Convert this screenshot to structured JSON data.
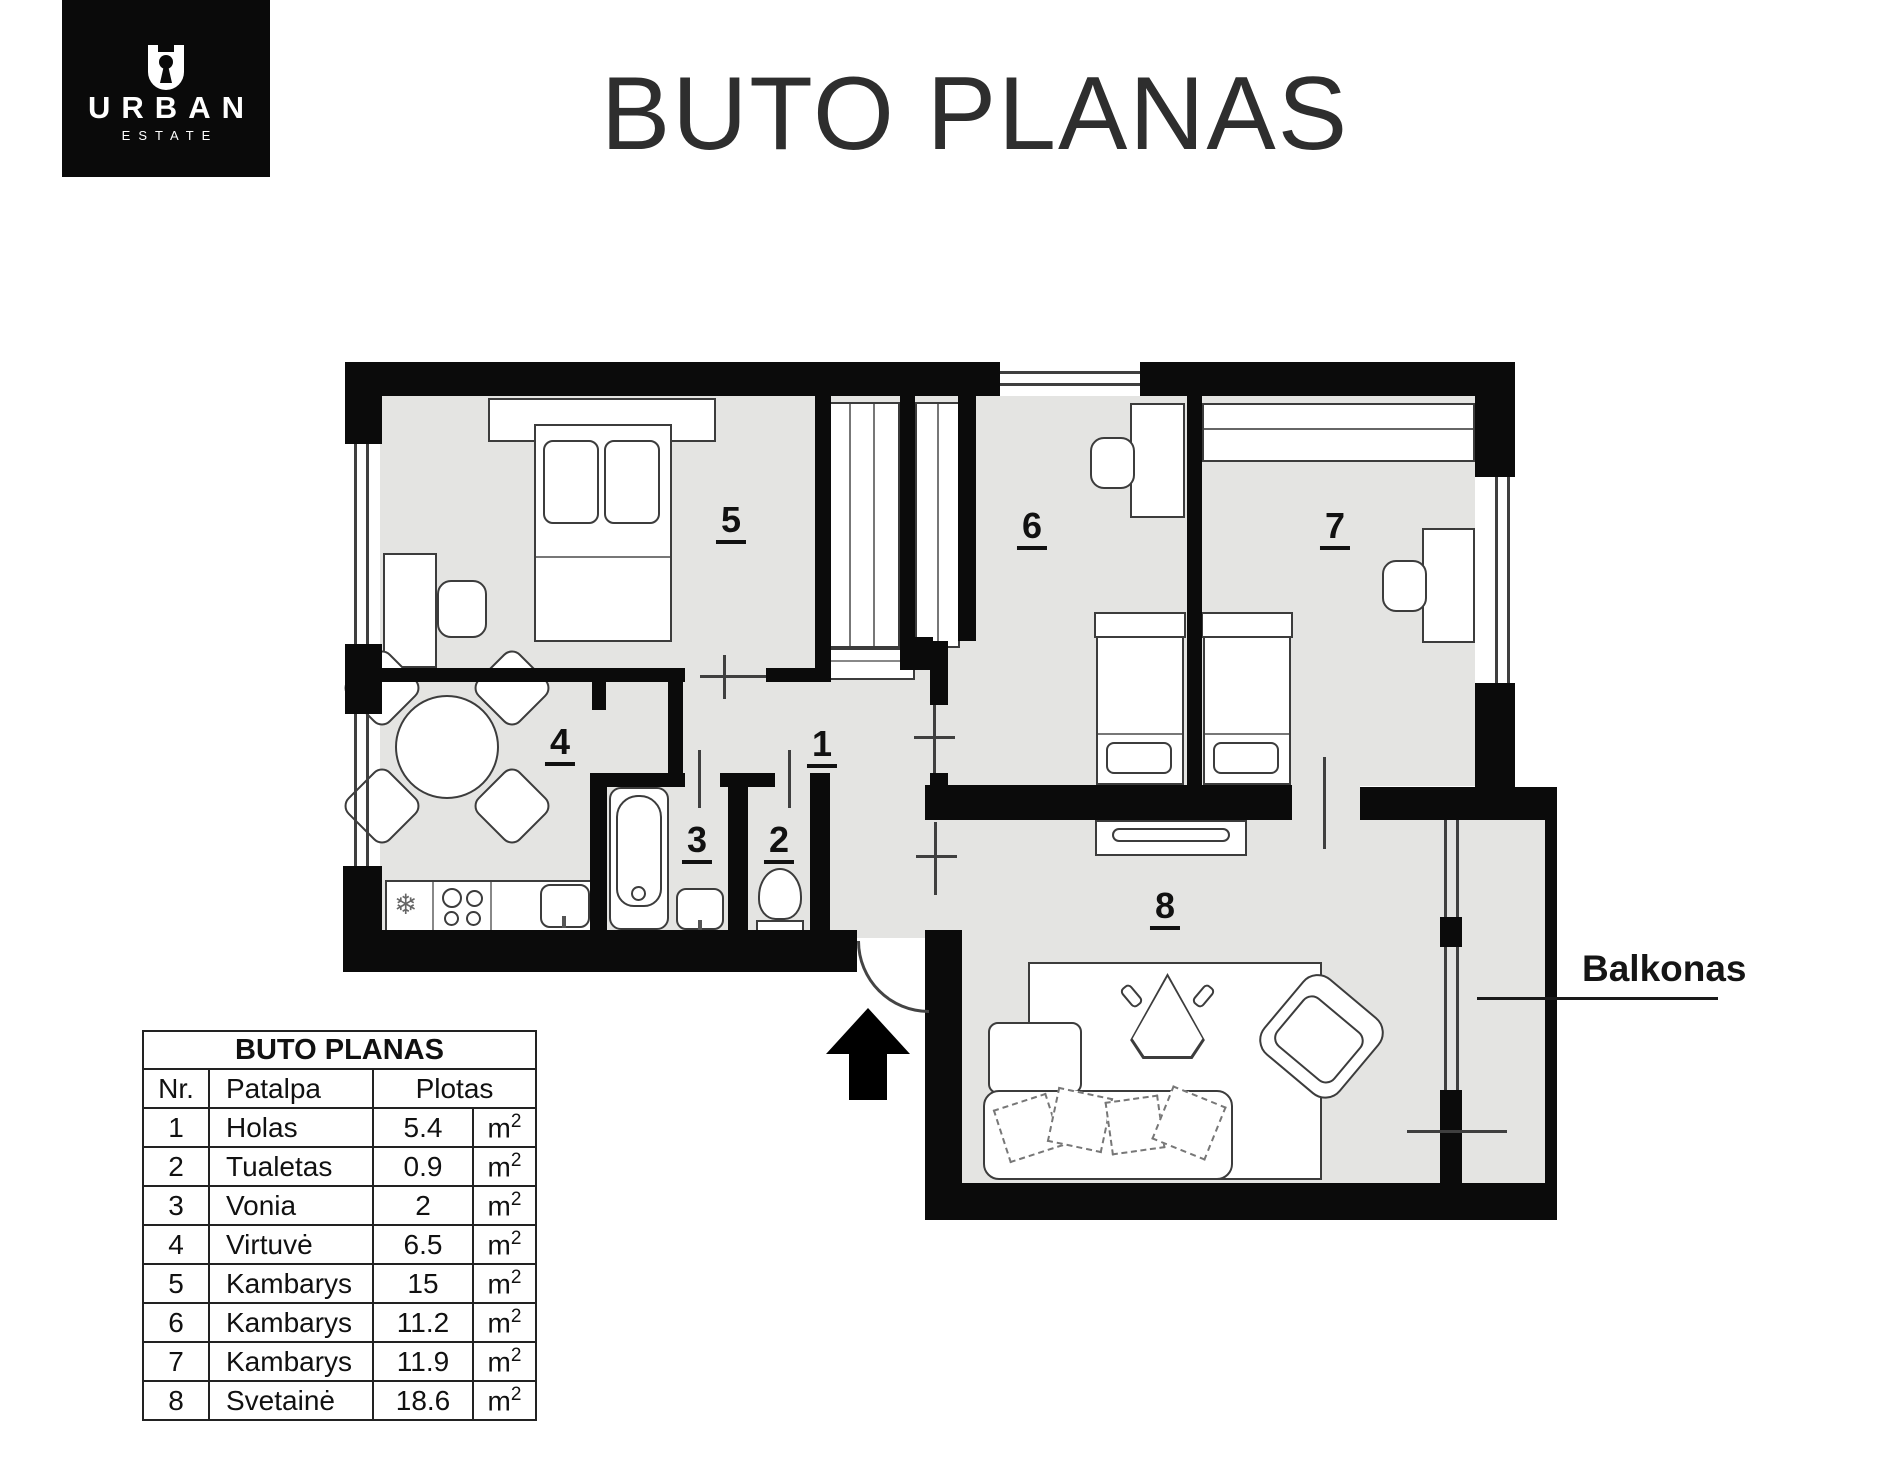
{
  "colors": {
    "wall": "#0b0b0b",
    "room_fill": "#e4e4e2",
    "logo_bg": "#0a0a0a",
    "text": "#111111"
  },
  "logo": {
    "brand": "URBAN",
    "sub": "ESTATE",
    "icon": "keyhole-icon"
  },
  "title": "BUTO PLANAS",
  "plan": {
    "room_numbers": [
      {
        "label": "1"
      },
      {
        "label": "2"
      },
      {
        "label": "3"
      },
      {
        "label": "4"
      },
      {
        "label": "5"
      },
      {
        "label": "6"
      },
      {
        "label": "7"
      },
      {
        "label": "8"
      }
    ],
    "balcony_label": "Balkonas",
    "freezer_icon": "❄"
  },
  "table": {
    "title": "BUTO PLANAS",
    "headers": {
      "nr": "Nr.",
      "name": "Patalpa",
      "area": "Plotas"
    },
    "rows": [
      {
        "nr": "1",
        "name": "Holas",
        "value": "5.4",
        "unit": "m",
        "unit_sup": "2"
      },
      {
        "nr": "2",
        "name": "Tualetas",
        "value": "0.9",
        "unit": "m",
        "unit_sup": "2"
      },
      {
        "nr": "3",
        "name": "Vonia",
        "value": "2",
        "unit": "m",
        "unit_sup": "2"
      },
      {
        "nr": "4",
        "name": "Virtuvė",
        "value": "6.5",
        "unit": "m",
        "unit_sup": "2"
      },
      {
        "nr": "5",
        "name": "Kambarys",
        "value": "15",
        "unit": "m",
        "unit_sup": "2"
      },
      {
        "nr": "6",
        "name": "Kambarys",
        "value": "11.2",
        "unit": "m",
        "unit_sup": "2"
      },
      {
        "nr": "7",
        "name": "Kambarys",
        "value": "11.9",
        "unit": "m",
        "unit_sup": "2"
      },
      {
        "nr": "8",
        "name": "Svetainė",
        "value": "18.6",
        "unit": "m",
        "unit_sup": "2"
      }
    ]
  }
}
